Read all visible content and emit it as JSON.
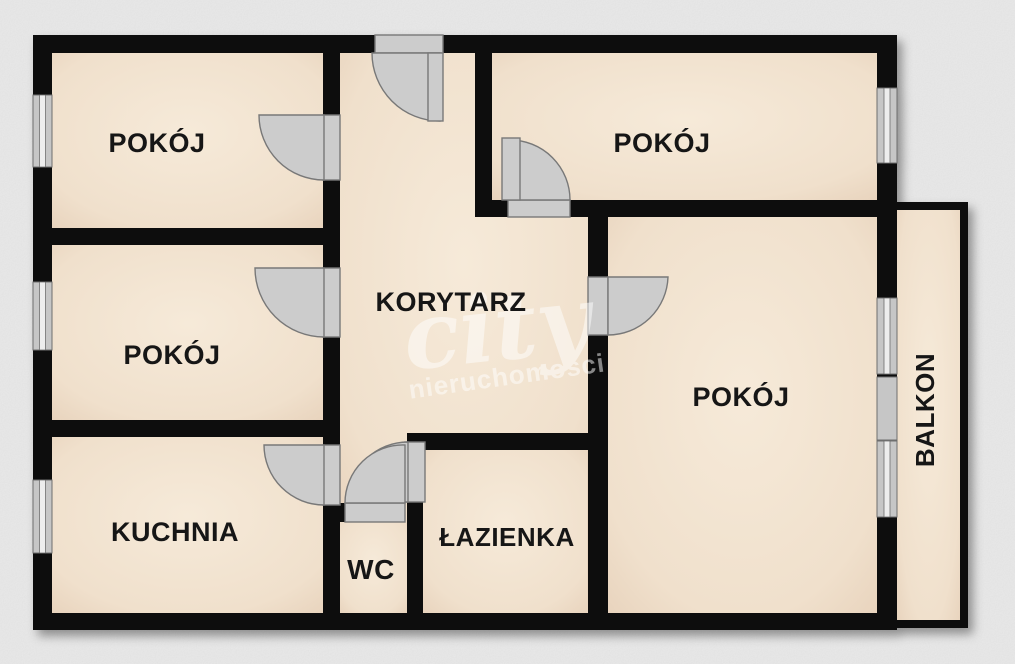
{
  "plan_type": "apartment-floor-plan",
  "rooms": {
    "room_top_left": "POKÓJ",
    "room_mid_left": "POKÓJ",
    "kitchen": "KUCHNIA",
    "corridor": "KORYTARZ",
    "room_top_right": "POKÓJ",
    "room_right": "POKÓJ",
    "bathroom": "ŁAZIENKA",
    "wc": "WC",
    "balcony": "BALKON"
  },
  "watermark": {
    "brand": "city",
    "subtitle": "nieruchomości"
  },
  "colors": {
    "background": "#ececec",
    "wall": "#0f0f0f",
    "floor_light": "#f6ead9",
    "floor_dark": "#e7d2bb",
    "door_fill": "#cccccc",
    "door_stroke": "#787878",
    "window_frame": "#c6c6c6",
    "window_pane": "#ededed",
    "label": "#161616",
    "watermark_white": "#ffffff"
  }
}
